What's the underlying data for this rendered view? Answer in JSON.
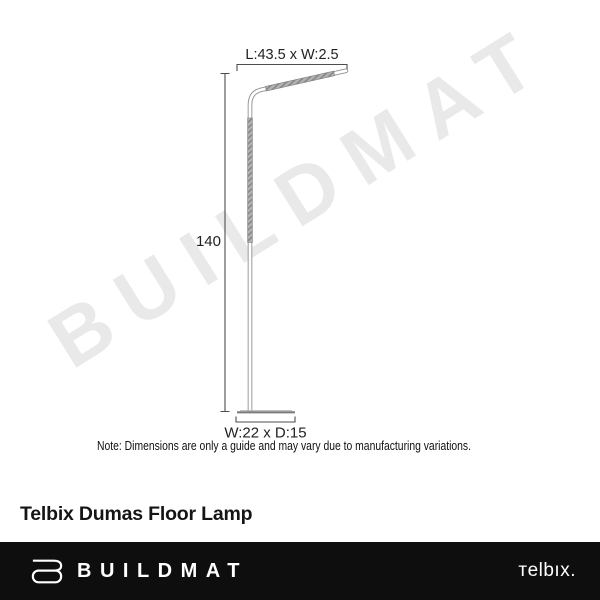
{
  "watermark": {
    "text": "BUILDMAT",
    "color": "#e9e9e9"
  },
  "diagram": {
    "arm_dimension_label": "L:43.5 x W:2.5",
    "height_dimension_label": "140",
    "base_dimension_label": "W:22 x D:15",
    "note": "Note: Dimensions are only a guide and may vary due to manufacturing variations."
  },
  "product": {
    "title": "Telbix Dumas Floor Lamp"
  },
  "footer": {
    "brand": "BUILDMAT",
    "brand_icon": "buildmat-b-icon",
    "supplier_logo": "тelbıx.",
    "background_color": "#0e0e0e",
    "text_color": "#ffffff"
  }
}
